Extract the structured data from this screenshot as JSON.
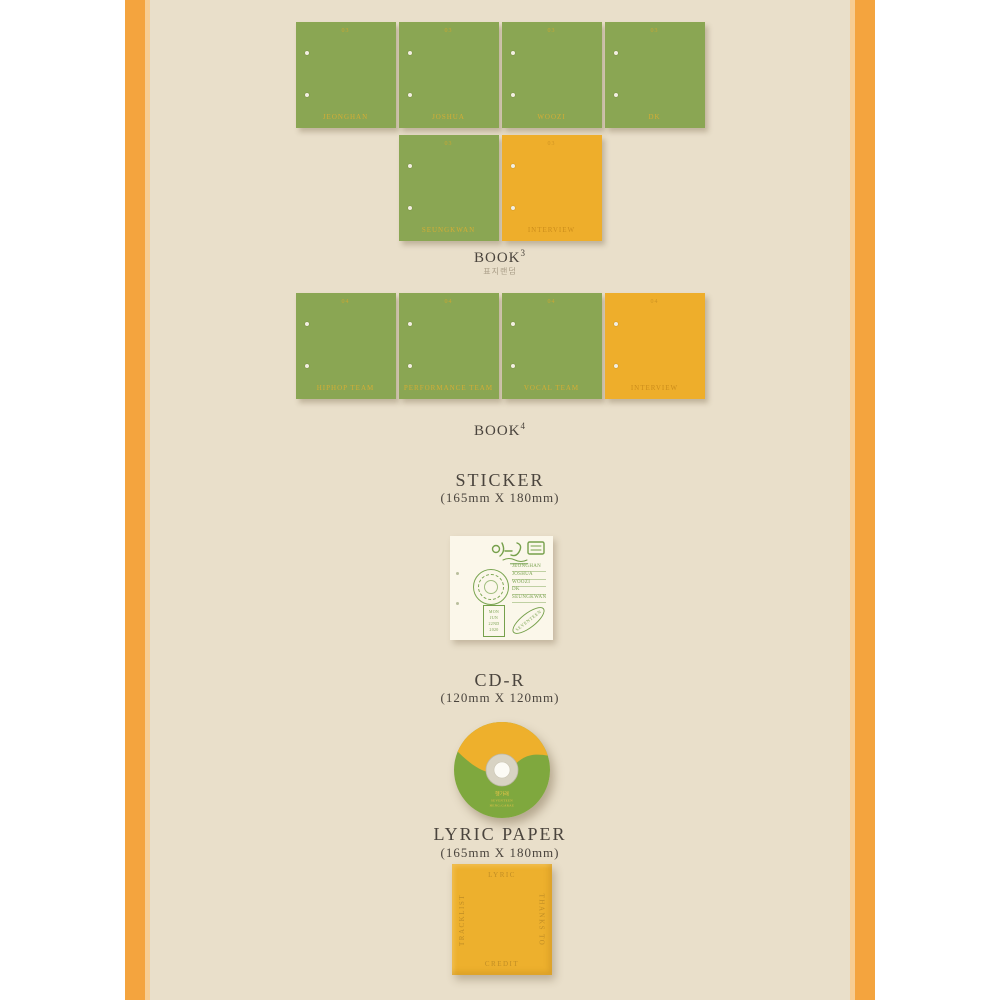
{
  "frame": {
    "orange": "#f4a43e",
    "light_stripe": "#f7cd92",
    "beige_background": "#e9dfca",
    "outer_background": "#ffffff"
  },
  "colors": {
    "book_green": "#8aa653",
    "book_yellow": "#eeae2b",
    "book_text_gold": "#d4ad35",
    "heading_text": "#4a443d",
    "sticker_green": "#76a04b",
    "paper_yellow": "#edb02d",
    "paper_text": "#c08d25"
  },
  "book3": {
    "title": "BOOK",
    "sup": "3",
    "subtitle_kr": "표지랜덤",
    "covers_row1": [
      {
        "num": "03",
        "name": "JEONGHAN"
      },
      {
        "num": "03",
        "name": "JOSHUA"
      },
      {
        "num": "03",
        "name": "WOOZI"
      },
      {
        "num": "03",
        "name": "DK"
      }
    ],
    "covers_row2": [
      {
        "num": "03",
        "name": "SEUNGKWAN"
      },
      {
        "num": "03",
        "name": "INTERVIEW"
      }
    ]
  },
  "book4": {
    "title": "BOOK",
    "sup": "4",
    "covers": [
      {
        "num": "04",
        "name": "HIPHOP TEAM"
      },
      {
        "num": "04",
        "name": "PERFORMANCE TEAM"
      },
      {
        "num": "04",
        "name": "VOCAL TEAM"
      },
      {
        "num": "04",
        "name": "INTERVIEW"
      }
    ]
  },
  "sticker": {
    "title": "STICKER",
    "size": "(165mm X 180mm)",
    "logo": "hanggarae-doodle-logo",
    "names": [
      "JEONGHAN",
      "JOSHUA",
      "WOOZI",
      "DK",
      "SEUNGKWAN"
    ],
    "date_lines": [
      "MON",
      "JUN",
      "22ND",
      "2020"
    ],
    "oval_text": "SEVENTEEN"
  },
  "cd": {
    "title": "CD-R",
    "size": "(120mm X 120mm)",
    "label_lines": [
      "헹가래",
      "SEVENTEEN",
      "HENG:GARAE"
    ]
  },
  "lyric_paper": {
    "title": "LYRIC PAPER",
    "size": "(165mm X 180mm)",
    "edge_top": "LYRIC",
    "edge_left": "TRACKLIST",
    "edge_right": "THANKS TO",
    "edge_bottom": "CREDIT"
  }
}
